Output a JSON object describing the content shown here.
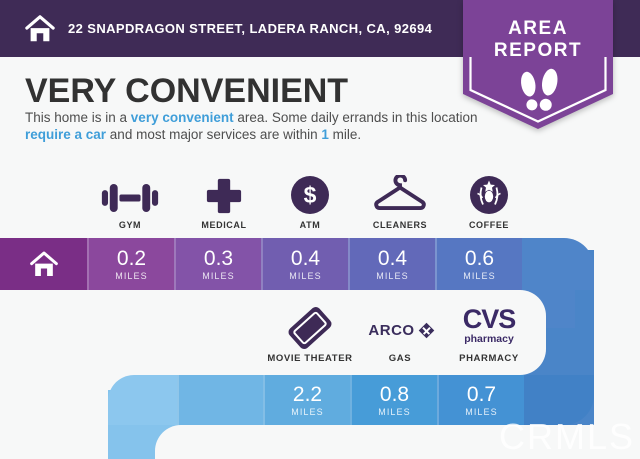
{
  "header": {
    "address": "22 SNAPDRAGON STREET, LADERA RANCH, CA, 92694"
  },
  "badge": {
    "line1": "AREA",
    "line2": "REPORT"
  },
  "title": "VERY CONVENIENT",
  "description": {
    "segments": [
      {
        "text": "This home is in a ",
        "highlight": false
      },
      {
        "text": "very convenient",
        "highlight": true
      },
      {
        "text": " area. Some daily errands in this location ",
        "highlight": false
      },
      {
        "text": "require a car",
        "highlight": true
      },
      {
        "text": " and most major services are within ",
        "highlight": false
      },
      {
        "text": "1",
        "highlight": true
      },
      {
        "text": " mile.",
        "highlight": false
      }
    ]
  },
  "row1": {
    "items": [
      {
        "label": "GYM",
        "icon": "dumbbell-icon",
        "distance": "0.2",
        "unit": "MILES",
        "color": "#8b489d"
      },
      {
        "label": "MEDICAL",
        "icon": "medical-cross-icon",
        "distance": "0.3",
        "unit": "MILES",
        "color": "#8353a8"
      },
      {
        "label": "ATM",
        "icon": "dollar-circle-icon",
        "distance": "0.4",
        "unit": "MILES",
        "color": "#715eb0"
      },
      {
        "label": "CLEANERS",
        "icon": "hanger-icon",
        "distance": "0.4",
        "unit": "MILES",
        "color": "#6269b9"
      },
      {
        "label": "COFFEE",
        "icon": "starbucks-siren-icon",
        "distance": "0.6",
        "unit": "MILES",
        "color": "#5677c2"
      }
    ]
  },
  "row2": {
    "items": [
      {
        "label": "MOVIE THEATER",
        "icon": "movie-ticket-icon",
        "distance": "2.2",
        "unit": "MILES",
        "color": "#60acdf"
      },
      {
        "label": "GAS",
        "icon": "arco-logo",
        "brand": "ARCO",
        "distance": "0.8",
        "unit": "MILES",
        "color": "#479cd8"
      },
      {
        "label": "PHARMACY",
        "icon": "cvs-logo",
        "brand_line1": "CVS",
        "brand_line2": "pharmacy",
        "distance": "0.7",
        "unit": "MILES",
        "color": "#4492d4"
      }
    ]
  },
  "watermark": "CRMLS",
  "palette": {
    "page_bg": "#f7f8f8",
    "header_bg": "#3f2b56",
    "badge_purple": "#7c4397",
    "icon_dark": "#3e2a56",
    "highlight_blue": "#3f9ed9",
    "bar1_home": "#7a2e86",
    "bar1_tail": "#4f85c9",
    "connector": "#4a85c8",
    "elbow": "#8cc7ee",
    "bar2_blank": "#70b6e5",
    "bar2_tail": "#4181c6",
    "column": "#85c3ec"
  }
}
